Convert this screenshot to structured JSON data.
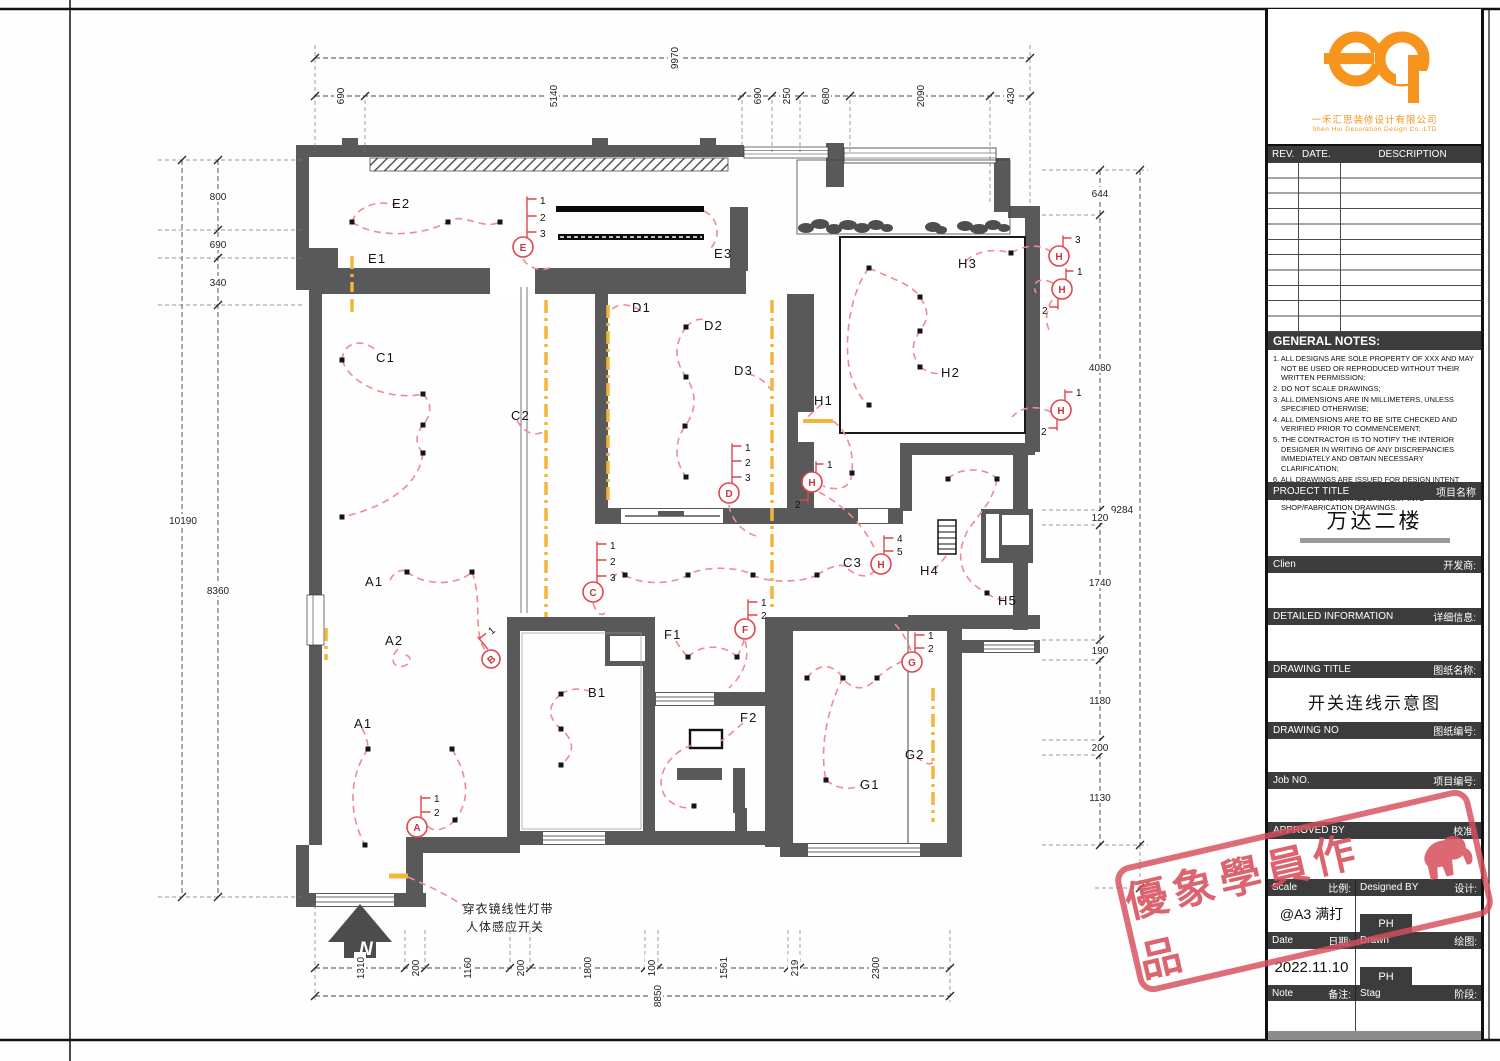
{
  "sheet": {
    "north_label": "N"
  },
  "title_block": {
    "company_cn": "一禾汇思装修设计有限公司",
    "company_en": "Shen Hui Decoration Design Co.,LTD",
    "rev_header": {
      "rev": "REV.",
      "date": "DATE.",
      "description": "DESCRIPTION"
    },
    "general_notes_title": "GENERAL NOTES:",
    "notes": [
      "1. ALL DESIGNS ARE SOLE PROPERTY OF XXX AND MAY NOT BE USED OR REPRODUCED WITHOUT THEIR WRITTEN PERMISSION;",
      "2. DO NOT SCALE DRAWINGS;",
      "3. ALL DIMENSIONS ARE IN MILLIMETERS, UNLESS SPECIFIED OTHERWISE;",
      "4. ALL DIMENSIONS ARE TO BE SITE CHECKED AND VERIFIED PRIOR TO COMMENCEMENT;",
      "5. THE CONTRACTOR IS TO NOTIFY THE INTERIOR DESIGNER IN WRITING OF ANY DISCREPANCIES IMMEDIATELY AND OBTAIN NECESSARY CLARIFICATION;",
      "6. ALL DRAWINGS ARE ISSUED FOR DESIGN INTENT AND WHERE REQUIRED ARE TO BE DEVELOPED BY THE CONTRACTOR ACCORDINGLY INTO SHOP/FABRICATION DRAWINGS."
    ],
    "sections": {
      "project_title": {
        "en": "PROJECT TITLE",
        "zh": "项目名称",
        "value": "万达二楼"
      },
      "client": {
        "en": "Clien",
        "zh": "开发商:"
      },
      "detailed_info": {
        "en": "DETAILED INFORMATION",
        "zh": "详细信息:"
      },
      "drawing_title": {
        "en": "DRAWING TITLE",
        "zh": "图纸名称:",
        "value": "开关连线示意图"
      },
      "drawing_no": {
        "en": "DRAWING NO",
        "zh": "图纸编号:"
      },
      "job_no": {
        "en": "Job NO.",
        "zh": "项目编号:"
      },
      "approved_by": {
        "en": "APPROVED BY",
        "zh": "校准:"
      },
      "scale": {
        "en": "Scale",
        "zh": "比例:",
        "value": "@A3 满打"
      },
      "designed_by": {
        "en": "Designed BY",
        "zh": "设计:",
        "value": "PH"
      },
      "date": {
        "en": "Date",
        "zh": "日期:",
        "value": "2022.11.10"
      },
      "drawn": {
        "en": "Drawn",
        "zh": "绘图:",
        "value": "PH"
      },
      "note": {
        "en": "Note",
        "zh": "备注:"
      },
      "stage": {
        "en": "Stag",
        "zh": "阶段:"
      }
    }
  },
  "watermark": {
    "text": "優象學員作品"
  },
  "plan": {
    "annotation": {
      "line1": "穿衣镜线性灯带",
      "line2": "人体感应开关"
    },
    "room_labels": [
      "E2",
      "E1",
      "E3",
      "C1",
      "C2",
      "D1",
      "D2",
      "D3",
      "H3",
      "H2",
      "H1",
      "A1",
      "A2",
      "A1",
      "B1",
      "F1",
      "F2",
      "C3",
      "H4",
      "H5",
      "G1",
      "G2"
    ],
    "switches": [
      {
        "letter": "E",
        "nums": [
          "1",
          "2",
          "3"
        ]
      },
      {
        "letter": "C",
        "nums": [
          "1",
          "2",
          "3"
        ]
      },
      {
        "letter": "D",
        "nums": [
          "1",
          "2",
          "3"
        ]
      },
      {
        "letter": "A",
        "nums": [
          "1",
          "2"
        ]
      },
      {
        "letter": "B",
        "nums": [
          "1"
        ]
      },
      {
        "letter": "F",
        "nums": [
          "1",
          "2"
        ]
      },
      {
        "letter": "G",
        "nums": [
          "1",
          "2"
        ]
      },
      {
        "letter": "H",
        "nums": [
          "3"
        ]
      },
      {
        "letter": "H",
        "nums": [
          "1",
          "2"
        ]
      },
      {
        "letter": "H",
        "nums": [
          "1",
          "2"
        ]
      },
      {
        "letter": "H",
        "nums": [
          "4",
          "5"
        ]
      },
      {
        "letter": "H",
        "nums": [
          "1",
          "2"
        ]
      }
    ],
    "dims": {
      "top_total": "9970",
      "top": [
        "690",
        "5140",
        "690",
        "250",
        "680",
        "2090",
        "430"
      ],
      "left_total": "10190",
      "left": [
        "800",
        "690",
        "340",
        "8360"
      ],
      "right_total": "9284",
      "right": [
        "644",
        "4080",
        "120",
        "1740",
        "190",
        "1180",
        "200",
        "1130"
      ],
      "bottom_total": "8850",
      "bottom": [
        "1310",
        "200",
        "1160",
        "200",
        "1800",
        "100",
        "1561",
        "219",
        "2300"
      ]
    }
  }
}
